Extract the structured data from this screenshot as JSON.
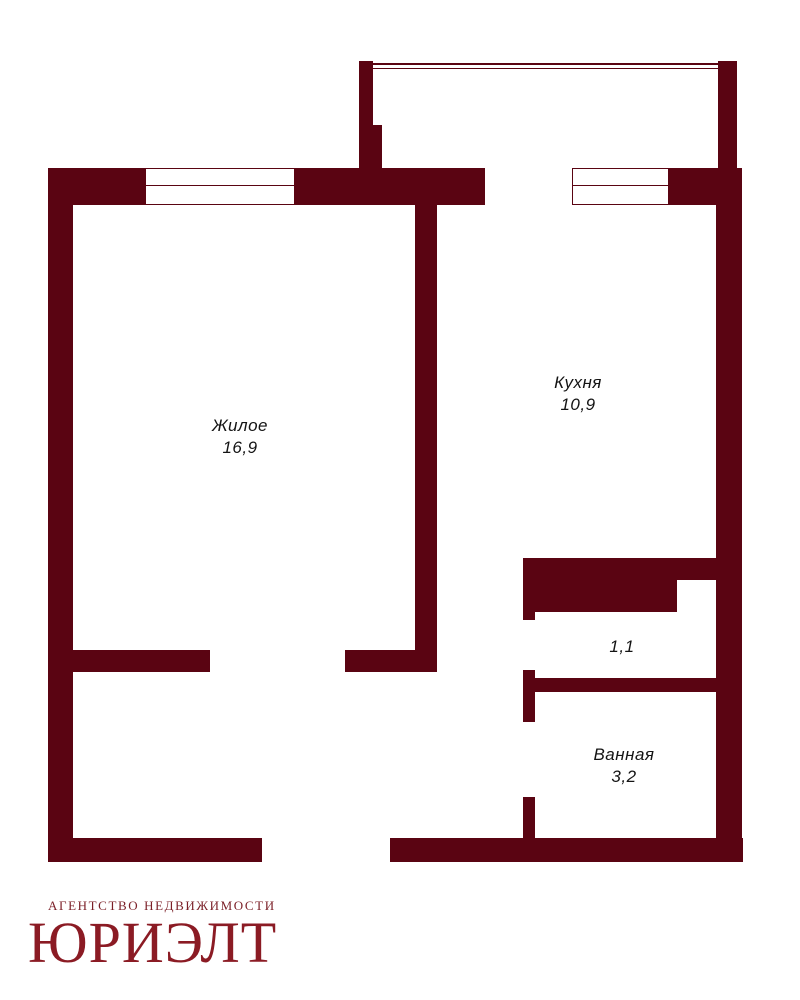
{
  "title": "Floor plan — 1-room apartment",
  "colors": {
    "wall": "#5a0412",
    "logo_main": "#8b1b24",
    "logo_sub": "#7b1f27",
    "label_text": "#141414"
  },
  "rooms": {
    "living": {
      "name": "Жилое",
      "area": "16,9"
    },
    "kitchen": {
      "name": "Кухня",
      "area": "10,9"
    },
    "hall": {
      "name": "",
      "area": "1,1"
    },
    "bath": {
      "name": "Ванная",
      "area": "3,2"
    }
  },
  "logo": {
    "subtitle": "АГЕНТСТВО НЕДВИЖИМОСТИ",
    "name": "ЮРИЭЛТ"
  }
}
